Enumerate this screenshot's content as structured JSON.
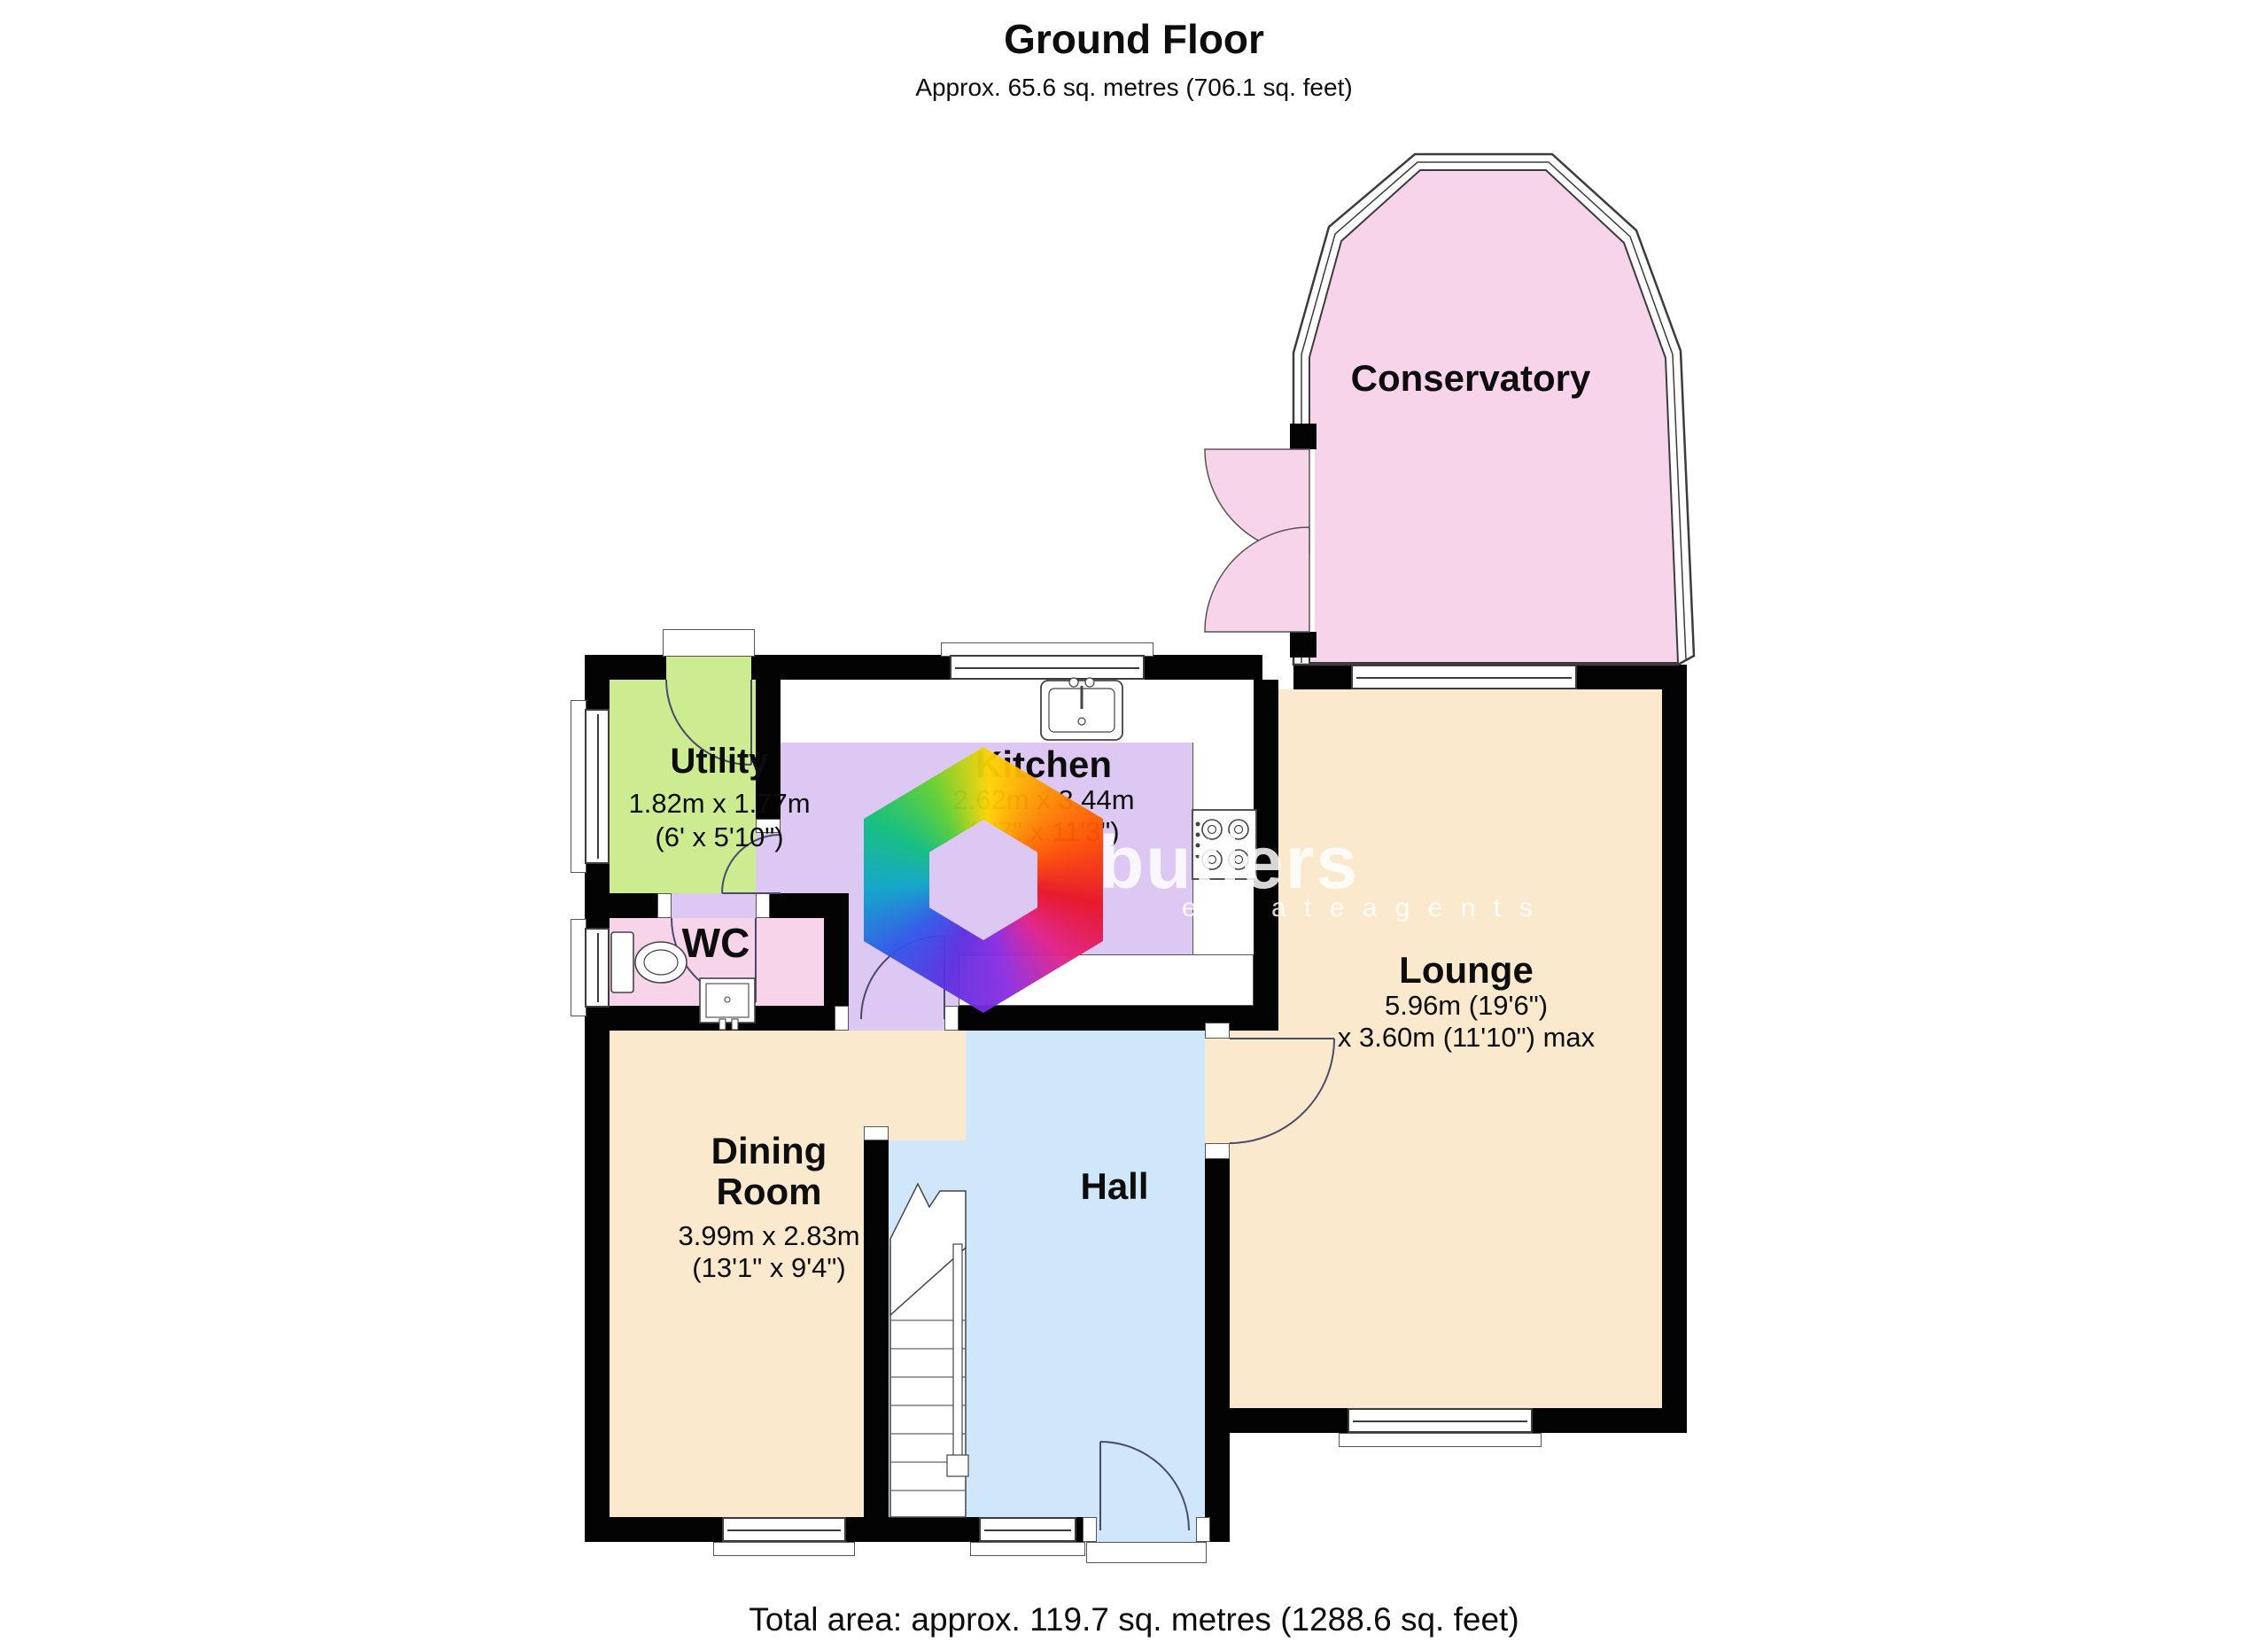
{
  "title": "Ground Floor",
  "subtitle": "Approx. 65.6 sq. metres (706.1 sq. feet)",
  "footer": "Total area: approx. 119.7 sq. metres (1288.6 sq. feet)",
  "watermark": {
    "brand": "butlers",
    "tagline": "e s t a t e   a g e n t s"
  },
  "rooms": {
    "conservatory": {
      "name": "Conservatory"
    },
    "utility": {
      "name": "Utility",
      "dims": "1.82m x 1.77m",
      "dims_imperial": "(6' x 5'10\")"
    },
    "kitchen": {
      "name": "Kitchen",
      "dims": "2.62m x 3.44m",
      "dims_imperial": "(8'7\" x 11'3\")"
    },
    "wc": {
      "name": "WC"
    },
    "lounge": {
      "name": "Lounge",
      "dims": "5.96m (19'6\")",
      "dims2": "x 3.60m (11'10\") max"
    },
    "dining": {
      "name1": "Dining",
      "name2": "Room",
      "dims": "3.99m x 2.83m",
      "dims_imperial": "(13'1\" x 9'4\")"
    },
    "hall": {
      "name": "Hall"
    }
  },
  "colors": {
    "wall": "#030303",
    "conservatory": "#f8d4ea",
    "utility": "#cdeb90",
    "kitchen": "#dcc8f2",
    "wc": "#f8d4ea",
    "lounge": "#fbe9cd",
    "dining": "#fbe9cd",
    "hall": "#cfe7f8"
  }
}
